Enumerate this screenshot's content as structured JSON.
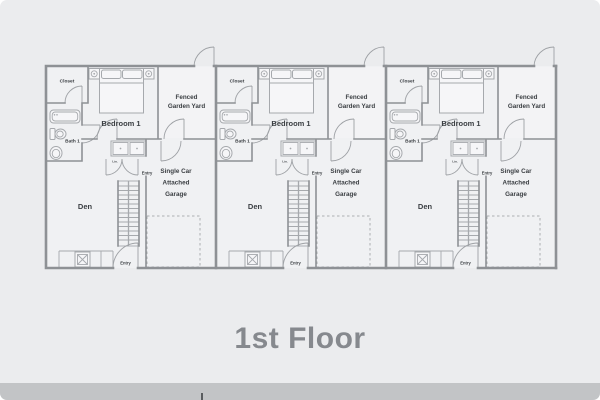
{
  "page": {
    "title": "1st Floor"
  },
  "theme": {
    "background": "#ebecee",
    "wall_color": "#8e9195",
    "fixture_color": "#a6a9ad",
    "label_color": "#3a3e42",
    "title_color": "#86898e",
    "footer_bar_color": "#c2c4c6"
  },
  "floorplan": {
    "unit_count": 3,
    "units": [
      {
        "labels": {
          "closet": "Closet",
          "bath": "Bath 1",
          "bedroom": "Bedroom 1",
          "yard_line1": "Fenced",
          "yard_line2": "Garden Yard",
          "entry_upper": "Entry",
          "garage_line1": "Single Car",
          "garage_line2": "Attached",
          "garage_line3": "Garage",
          "den": "Den",
          "entry_lower": "Entry",
          "utility_tag": "Lin."
        }
      },
      {
        "labels": {
          "closet": "Closet",
          "bath": "Bath 1",
          "bedroom": "Bedroom 1",
          "yard_line1": "Fenced",
          "yard_line2": "Garden Yard",
          "entry_upper": "Entry",
          "garage_line1": "Single Car",
          "garage_line2": "Attached",
          "garage_line3": "Garage",
          "den": "Den",
          "entry_lower": "Entry",
          "utility_tag": "Lin."
        }
      },
      {
        "labels": {
          "closet": "Closet",
          "bath": "Bath 1",
          "bedroom": "Bedroom 1",
          "yard_line1": "Fenced",
          "yard_line2": "Garden Yard",
          "entry_upper": "Entry",
          "garage_line1": "Single Car",
          "garage_line2": "Attached",
          "garage_line3": "Garage",
          "den": "Den",
          "entry_lower": "Entry",
          "utility_tag": "Lin."
        }
      }
    ]
  }
}
